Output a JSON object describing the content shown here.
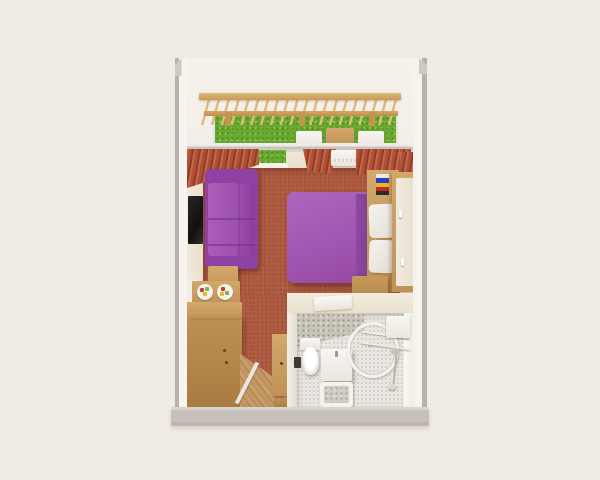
{
  "scene": {
    "title": "3D cutaway floor plan of a studio hotel room with balcony",
    "view": "top-down isometric render",
    "background_color": "#f1ebe5"
  },
  "palette": {
    "wall_edge_gray": "#b8b2ac",
    "wall_face_white": "#f7f4ef",
    "carpet_red": "#ad5a40",
    "upholstery_purple": "#a55fb5",
    "purple_shadow": "#7d4090",
    "curtain_terracotta": "#b4513a",
    "hedge_green": "#69a931",
    "wood_light": "#cfa76a",
    "wood_mid": "#b68b4f",
    "bathroom_tile": "#e9e6e1",
    "tv_black": "#1b1b1b"
  },
  "rooms": {
    "balcony": {
      "label": "Balcony with pergola",
      "pergola": "Wooden pergola with slatted roof",
      "hedge": "Green hedge privacy wall",
      "chair_left": "White balcony chair",
      "chair_right": "White balcony chair",
      "table": "Wooden balcony table"
    },
    "living_bedroom": {
      "label": "Living / bedroom",
      "sofa": "Purple three-seat sofa",
      "tv": "Wall-mounted TV",
      "side_table": "Wooden side table",
      "counter": "Breakfast counter with two food plates",
      "plate": "Plate with fruit",
      "dresser": "Wooden dresser cabinet",
      "bed": "Double bed with purple duvet",
      "pillow": "White pillow",
      "headboard": "Wooden headboard shelf",
      "books": "Stack of colored books",
      "wardrobe": "Wardrobe with white doors",
      "bench": "Wooden luggage bench",
      "curtains": "Terracotta curtains",
      "window": "Window with hedge view",
      "ac": "Air-conditioning unit",
      "wall_art": "Purple wall accent"
    },
    "bathroom": {
      "label": "Bathroom",
      "toilet": "Toilet",
      "bin": "Black waste bin",
      "vanity": "Washbasin cabinet",
      "shower": "Curved shower screen",
      "rails": "Towel rails",
      "boiler": "Wall boiler box",
      "hand_shower": "Hand shower on hose",
      "tray": "Shower tray",
      "towel": "Folded white towel on ledge",
      "wallpaper": "Speckled stone wallpaper"
    },
    "entry": {
      "label": "Entry hall",
      "parquet": "Diagonal parquet floor",
      "threshold": "Door threshold strip",
      "cabinet": "Tall wooden hall cabinet",
      "stool": "Wooden step stool"
    },
    "structure": {
      "left_wall": "Left exterior wall",
      "right_wall": "Right exterior wall",
      "bottom_wall": "Front exterior wall",
      "window_wall": "Window wall between room and balcony"
    }
  }
}
